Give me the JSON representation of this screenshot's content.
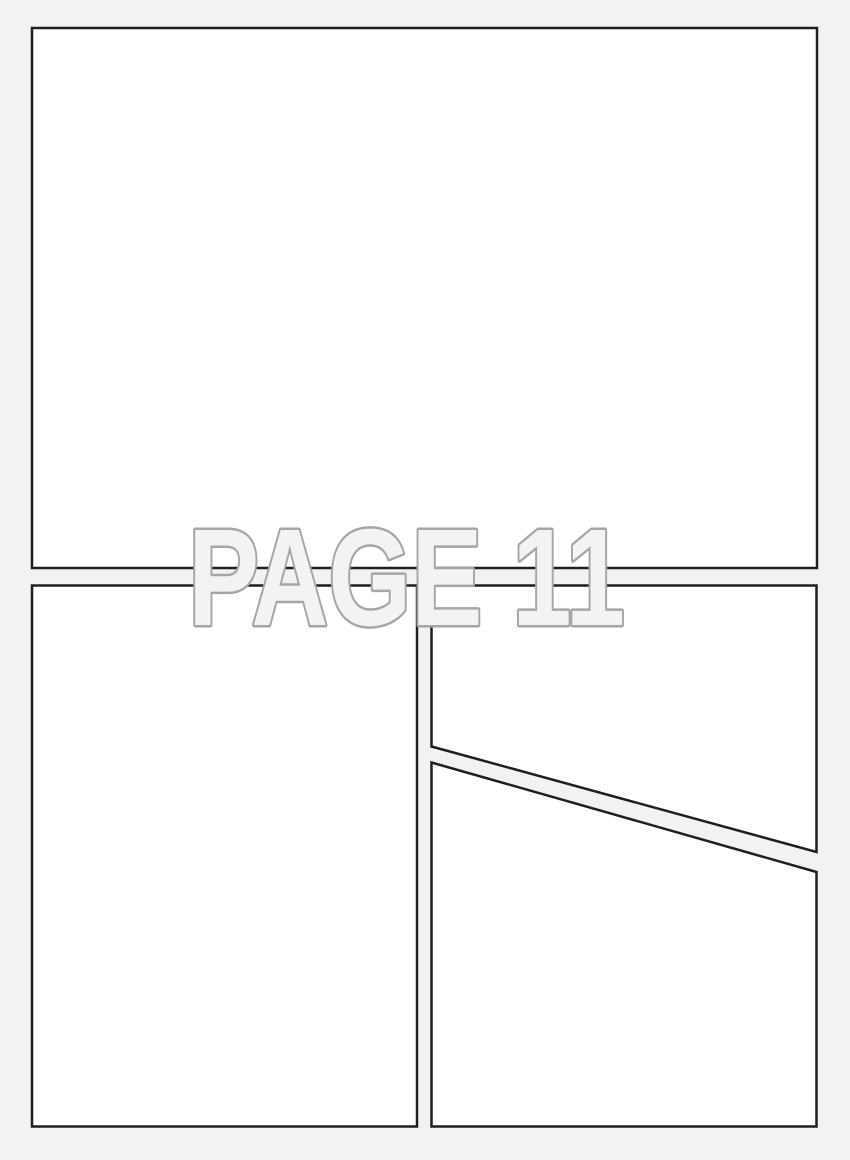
{
  "page": {
    "label": "PAGE 11",
    "colors": {
      "background": "#f2f2f2",
      "panel_fill": "#ffffff",
      "panel_border": "#1f1f1f",
      "label_fill": "#f3f3f3",
      "label_stroke": "#a6a6a6"
    }
  }
}
